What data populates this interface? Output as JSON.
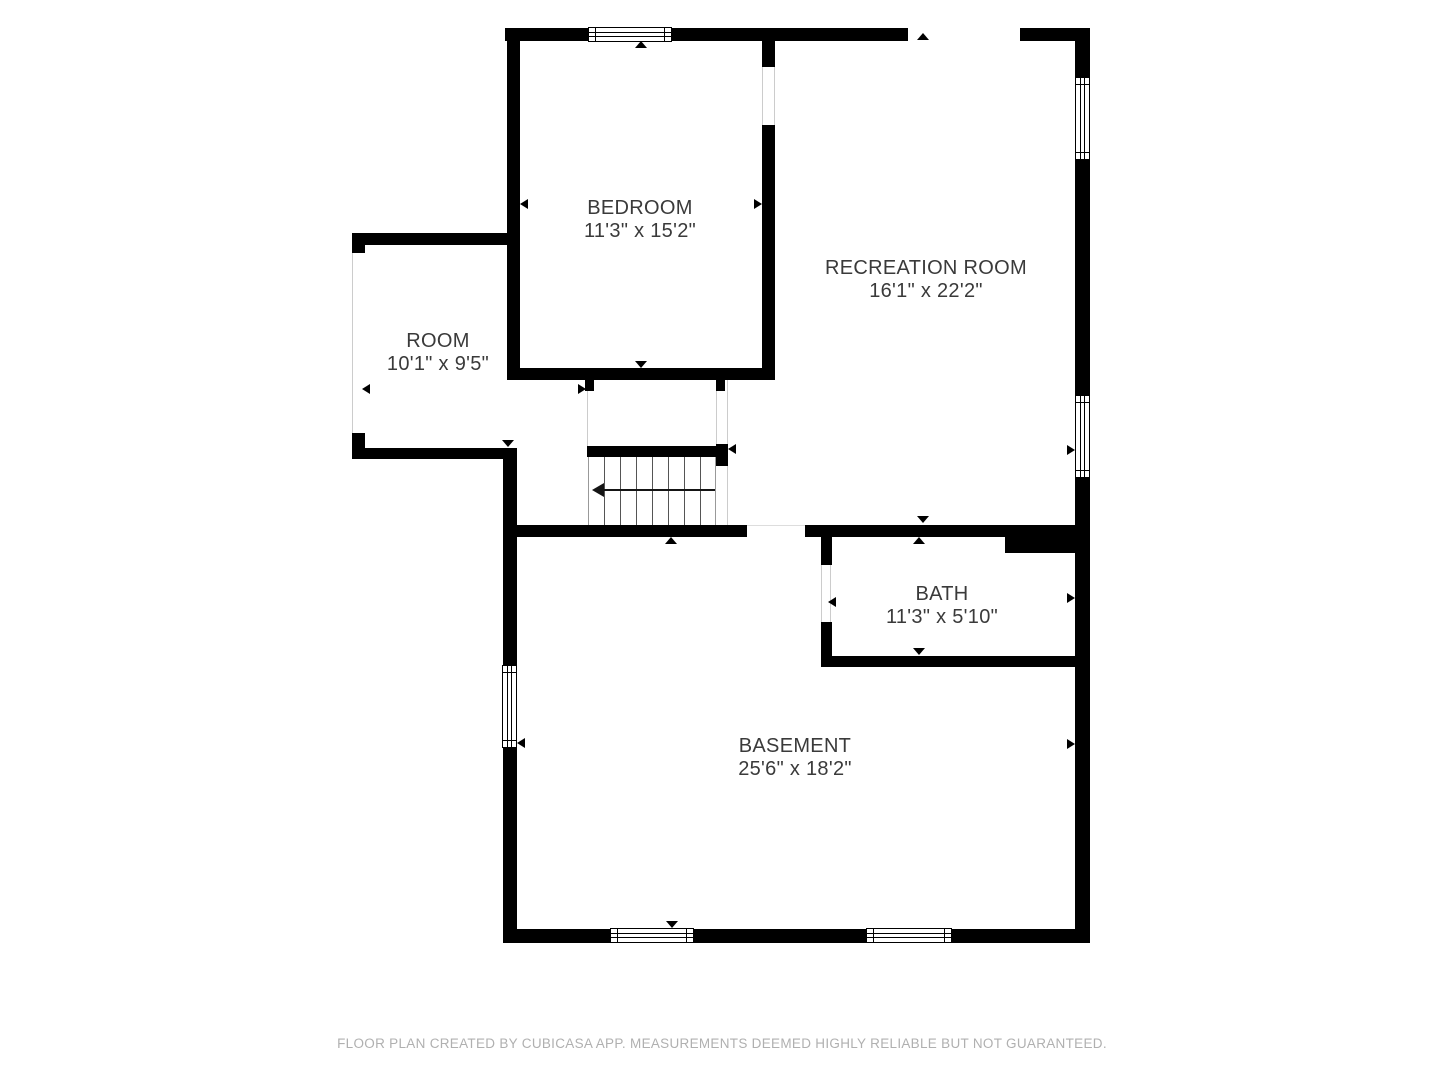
{
  "plan": {
    "creator_note": "FLOOR PLAN CREATED BY CUBICASA APP. MEASUREMENTS DEEMED HIGHLY RELIABLE BUT NOT GUARANTEED.",
    "colors": {
      "wall": "#000000",
      "label": "#3a3a3a",
      "footer_text": "#b0b0b0",
      "opening_line": "#cccccc"
    },
    "rooms": [
      {
        "id": "bedroom",
        "name": "BEDROOM",
        "dims": "11'3\" x 15'2\""
      },
      {
        "id": "recreation-room",
        "name": "RECREATION ROOM",
        "dims": "16'1\" x 22'2\""
      },
      {
        "id": "room",
        "name": "ROOM",
        "dims": "10'1\" x 9'5\""
      },
      {
        "id": "bath",
        "name": "BATH",
        "dims": "11'3\" x 5'10\""
      },
      {
        "id": "basement",
        "name": "BASEMENT",
        "dims": "25'6\" x 18'2\""
      }
    ],
    "stairs": {
      "direction": "down-left",
      "treads": 7
    },
    "windows": 6
  }
}
